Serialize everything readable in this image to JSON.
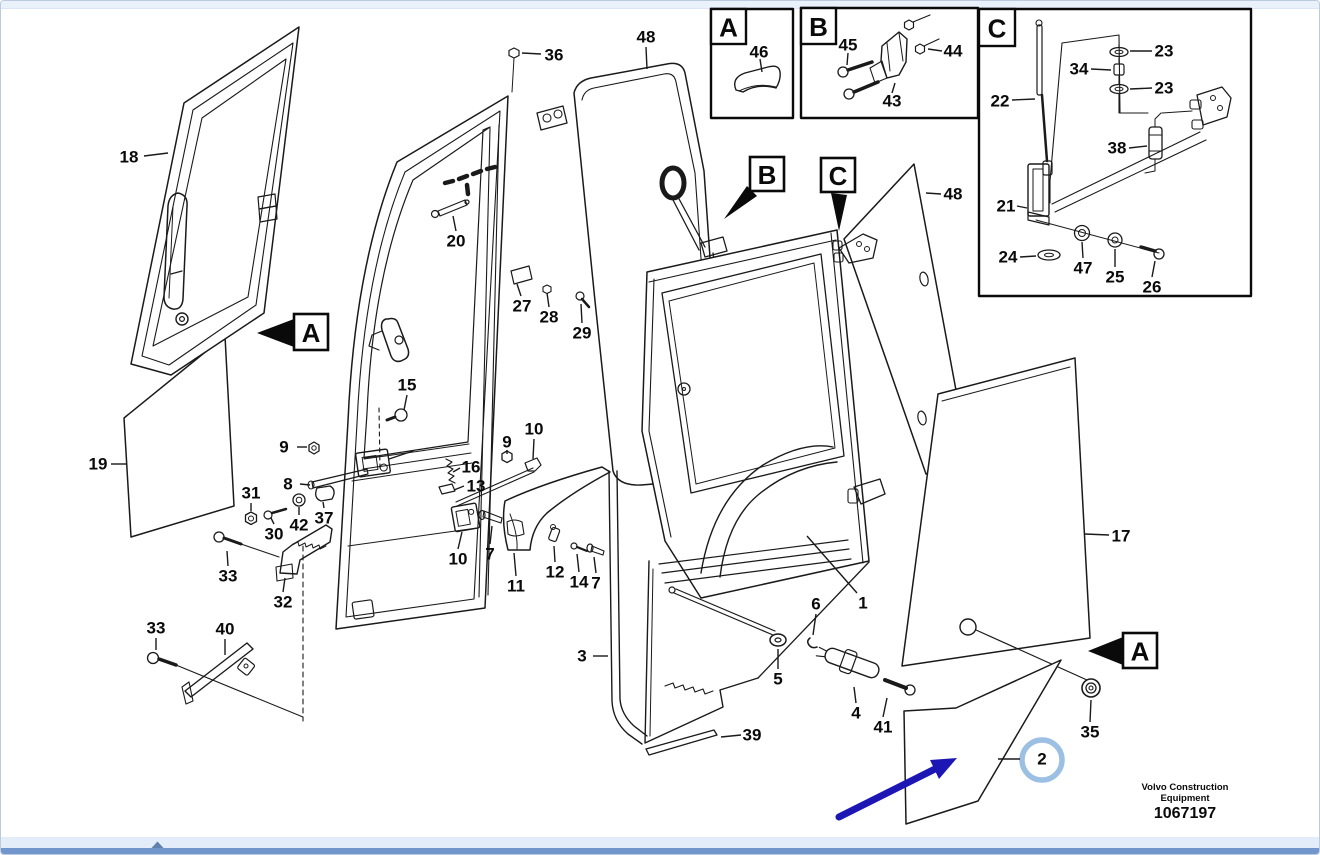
{
  "document": {
    "footer": {
      "brand_line1": "Volvo Construction",
      "brand_line2": "Equipment",
      "doc_number": "1067197"
    }
  },
  "viewer": {
    "top_strip_color": "#e9f1fb",
    "scroll_strip_color": "#e3edf9",
    "scroll_bar_color": "#7096cb",
    "scroll_arrow_icon": "scroll-up-arrow",
    "scroll_arrow_color": "#5f83ad"
  },
  "diagram": {
    "stroke_color": "#1a1a1a",
    "annotations": {
      "pointer_arrow_color": "#1c16b4",
      "highlight_ring_color": "#9cc0e4",
      "highlighted_part": "2"
    },
    "insets": [
      {
        "letter": "A",
        "box": [
          710,
          8,
          82,
          109
        ],
        "tab": [
          710,
          8,
          35,
          35
        ],
        "parts_shown": [
          "46"
        ]
      },
      {
        "letter": "B",
        "box": [
          800,
          7,
          177,
          110
        ],
        "tab": [
          800,
          7,
          35,
          36
        ],
        "parts_shown": [
          "43",
          "44",
          "45"
        ]
      },
      {
        "letter": "C",
        "box": [
          978,
          8,
          272,
          287
        ],
        "tab": [
          978,
          8,
          36,
          37
        ],
        "parts_shown": [
          "21",
          "22",
          "23",
          "24",
          "25",
          "26",
          "34",
          "38",
          "47"
        ]
      }
    ],
    "ref_markers": [
      {
        "letter": "A",
        "box": [
          293,
          313,
          34,
          36
        ],
        "arrow": "256,332 293,318 293,346"
      },
      {
        "letter": "B",
        "box": [
          749,
          156,
          34,
          34
        ],
        "arrow": "723,218 746,185 756,195"
      },
      {
        "letter": "C",
        "box": [
          820,
          157,
          34,
          34
        ],
        "arrow": "838,230 830,192 846,194"
      },
      {
        "letter": "A",
        "box": [
          1122,
          632,
          34,
          35
        ],
        "arrow": "1087,650 1122,636 1122,664"
      }
    ],
    "part_labels": [
      {
        "t": "18",
        "x": 128,
        "y": 156,
        "l": [
          143,
          155,
          167,
          152
        ]
      },
      {
        "t": "19",
        "x": 97,
        "y": 463,
        "l": [
          110,
          463,
          125,
          463
        ]
      },
      {
        "t": "36",
        "x": 553,
        "y": 54,
        "l": [
          540,
          53,
          521,
          52
        ]
      },
      {
        "t": "48",
        "x": 645,
        "y": 36,
        "l": [
          645,
          46,
          646,
          68
        ]
      },
      {
        "t": "20",
        "x": 455,
        "y": 240,
        "l": [
          455,
          230,
          452,
          215
        ]
      },
      {
        "t": "27",
        "x": 521,
        "y": 305,
        "l": [
          520,
          295,
          516,
          283
        ]
      },
      {
        "t": "28",
        "x": 548,
        "y": 316,
        "l": [
          548,
          306,
          546,
          292
        ]
      },
      {
        "t": "29",
        "x": 581,
        "y": 332,
        "l": [
          581,
          322,
          580,
          303
        ]
      },
      {
        "t": "15",
        "x": 406,
        "y": 384,
        "l": [
          406,
          394,
          403,
          409
        ]
      },
      {
        "t": "9",
        "x": 283,
        "y": 446,
        "l": [
          296,
          446,
          306,
          446
        ]
      },
      {
        "t": "8",
        "x": 287,
        "y": 483,
        "l": [
          299,
          483,
          309,
          484
        ]
      },
      {
        "t": "31",
        "x": 250,
        "y": 492,
        "l": [
          250,
          502,
          250,
          510
        ]
      },
      {
        "t": "30",
        "x": 273,
        "y": 533,
        "l": [
          273,
          523,
          270,
          517
        ]
      },
      {
        "t": "42",
        "x": 298,
        "y": 524,
        "l": [
          298,
          514,
          298,
          506
        ]
      },
      {
        "t": "37",
        "x": 323,
        "y": 517,
        "l": [
          323,
          507,
          322,
          501
        ]
      },
      {
        "t": "16",
        "x": 470,
        "y": 466,
        "l": [
          459,
          467,
          452,
          471
        ]
      },
      {
        "t": "13",
        "x": 475,
        "y": 485,
        "l": [
          463,
          485,
          453,
          489
        ]
      },
      {
        "t": "9",
        "x": 506,
        "y": 441,
        "l": [
          506,
          449,
          506,
          453
        ]
      },
      {
        "t": "10",
        "x": 533,
        "y": 428,
        "l": [
          533,
          438,
          532,
          458
        ]
      },
      {
        "t": "10",
        "x": 457,
        "y": 558,
        "l": [
          457,
          548,
          461,
          531
        ]
      },
      {
        "t": "7",
        "x": 489,
        "y": 553,
        "l": [
          489,
          543,
          491,
          525
        ]
      },
      {
        "t": "11",
        "x": 515,
        "y": 585,
        "l": [
          515,
          575,
          513,
          552
        ]
      },
      {
        "t": "12",
        "x": 554,
        "y": 571,
        "l": [
          554,
          561,
          553,
          545
        ]
      },
      {
        "t": "14",
        "x": 578,
        "y": 581,
        "l": [
          578,
          571,
          576,
          553
        ]
      },
      {
        "t": "7",
        "x": 595,
        "y": 582,
        "l": [
          595,
          572,
          593,
          556
        ]
      },
      {
        "t": "33",
        "x": 227,
        "y": 575,
        "l": [
          227,
          565,
          226,
          550
        ]
      },
      {
        "t": "32",
        "x": 282,
        "y": 601,
        "l": [
          282,
          591,
          284,
          577
        ]
      },
      {
        "t": "33",
        "x": 155,
        "y": 627,
        "l": [
          155,
          637,
          155,
          649
        ]
      },
      {
        "t": "40",
        "x": 224,
        "y": 628,
        "l": [
          224,
          638,
          224,
          654
        ]
      },
      {
        "t": "3",
        "x": 581,
        "y": 655,
        "l": [
          592,
          655,
          607,
          655
        ]
      },
      {
        "t": "39",
        "x": 751,
        "y": 734,
        "l": [
          740,
          734,
          720,
          736
        ]
      },
      {
        "t": "5",
        "x": 777,
        "y": 678,
        "l": [
          777,
          668,
          777,
          648
        ]
      },
      {
        "t": "6",
        "x": 815,
        "y": 603,
        "l": [
          815,
          613,
          812,
          634
        ]
      },
      {
        "t": "4",
        "x": 855,
        "y": 712,
        "l": [
          855,
          702,
          853,
          686
        ]
      },
      {
        "t": "41",
        "x": 882,
        "y": 726,
        "l": [
          882,
          716,
          886,
          697
        ]
      },
      {
        "t": "1",
        "x": 862,
        "y": 602,
        "l": [
          856,
          592,
          806,
          535
        ]
      },
      {
        "t": "48",
        "x": 952,
        "y": 193,
        "l": [
          940,
          193,
          925,
          192
        ]
      },
      {
        "t": "17",
        "x": 1120,
        "y": 535,
        "l": [
          1108,
          534,
          1084,
          533
        ]
      },
      {
        "t": "35",
        "x": 1089,
        "y": 731,
        "l": [
          1089,
          721,
          1090,
          699
        ]
      },
      {
        "t": "2",
        "x": 1041,
        "y": 758,
        "l": [
          1019,
          758,
          997,
          758
        ]
      },
      {
        "t": "22",
        "x": 999,
        "y": 100,
        "l": [
          1011,
          99,
          1034,
          98
        ]
      },
      {
        "t": "23",
        "x": 1163,
        "y": 50,
        "l": [
          1151,
          50,
          1129,
          50
        ]
      },
      {
        "t": "34",
        "x": 1078,
        "y": 68,
        "l": [
          1090,
          68,
          1110,
          69
        ]
      },
      {
        "t": "23",
        "x": 1163,
        "y": 87,
        "l": [
          1151,
          87,
          1129,
          88
        ]
      },
      {
        "t": "38",
        "x": 1116,
        "y": 147,
        "l": [
          1128,
          147,
          1146,
          145
        ]
      },
      {
        "t": "21",
        "x": 1005,
        "y": 205,
        "l": [
          1016,
          205,
          1026,
          207
        ]
      },
      {
        "t": "24",
        "x": 1007,
        "y": 256,
        "l": [
          1019,
          256,
          1035,
          255
        ]
      },
      {
        "t": "47",
        "x": 1082,
        "y": 267,
        "l": [
          1082,
          257,
          1081,
          241
        ]
      },
      {
        "t": "25",
        "x": 1114,
        "y": 276,
        "l": [
          1114,
          266,
          1114,
          248
        ]
      },
      {
        "t": "26",
        "x": 1151,
        "y": 286,
        "l": [
          1151,
          276,
          1154,
          260
        ]
      },
      {
        "t": "46",
        "x": 758,
        "y": 51,
        "l": [
          759,
          58,
          761,
          71
        ]
      },
      {
        "t": "45",
        "x": 847,
        "y": 44,
        "l": [
          847,
          52,
          846,
          64
        ]
      },
      {
        "t": "44",
        "x": 952,
        "y": 50,
        "l": [
          941,
          50,
          927,
          48
        ]
      },
      {
        "t": "43",
        "x": 891,
        "y": 100,
        "l": [
          891,
          92,
          894,
          82
        ]
      }
    ]
  }
}
